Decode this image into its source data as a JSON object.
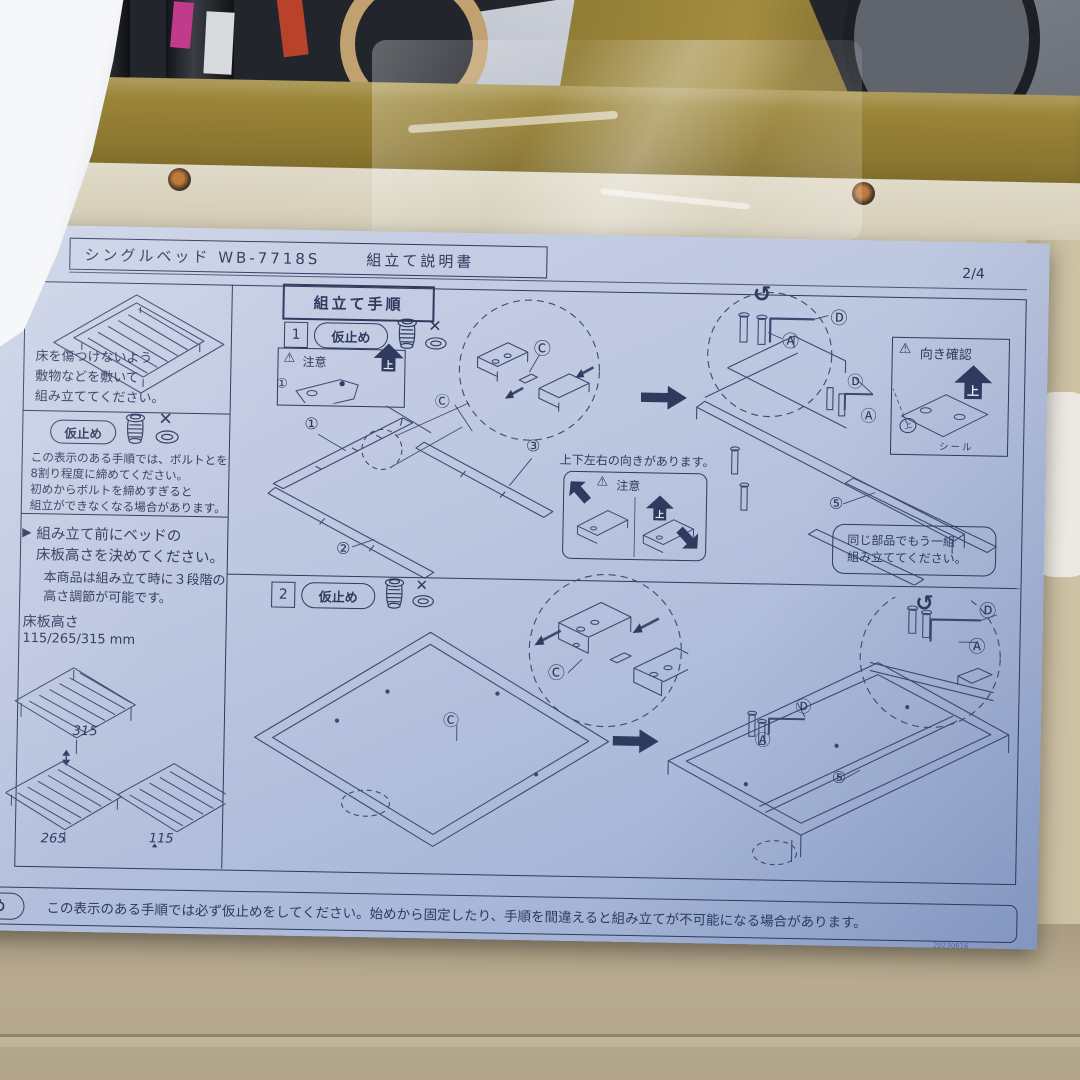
{
  "colors": {
    "paper": "#bdc7e0",
    "ink": "#2e3a5e",
    "gold": "#93803c",
    "cardboard": "#b3a58a",
    "cream_shelf": "#d9d3c1"
  },
  "icons": {
    "cross": "✕",
    "warning": "⚠",
    "rotate": "↺",
    "play_marker": "▶"
  },
  "sheet": {
    "header": {
      "product": "シングルベッド WB-7718S",
      "doc_title": "組立て説明書",
      "page": "2/4"
    },
    "left": {
      "floor_note": [
        "床を傷つけないよう",
        "敷物などを敷いて",
        "組み立ててください。"
      ],
      "karidome_label": "仮止め",
      "karidome_note": [
        "この表示のある手順では、ボルトとを",
        "8割り程度に締めてください。",
        "初めからボルトを締めすぎると",
        "組立ができなくなる場合があります。"
      ],
      "height_head": [
        "組み立て前にベッドの",
        "床板高さを決めてください。"
      ],
      "height_sub": [
        "本商品は組み立て時に３段階の",
        "高さ調節が可能です。"
      ],
      "height_label": "床板高さ",
      "height_values": "115/265/315 mm",
      "h315": "315",
      "h265": "265",
      "h115": "115"
    },
    "steps": {
      "title": "組立て手順",
      "step1_no": "1",
      "step2_no": "2",
      "karidome": "仮止め",
      "caution": "注意",
      "up": "上",
      "orientation_note": "上下左右の向きがあります。",
      "direction_check": "向き確認",
      "seal": "シール",
      "same_parts": [
        "同じ部品でもう一組",
        "組み立ててください。"
      ],
      "p1": "①",
      "p2": "②",
      "p3": "③",
      "p5": "⑤",
      "A": "Ⓐ",
      "C": "Ⓒ",
      "D": "Ⓓ"
    },
    "footer": {
      "label": "仮止め",
      "text": "この表示のある手順では必ず仮止めをしてください。始めから固定したり、手順を間違えると組み立てが不可能になる場合があります。",
      "date": "20230616"
    }
  }
}
